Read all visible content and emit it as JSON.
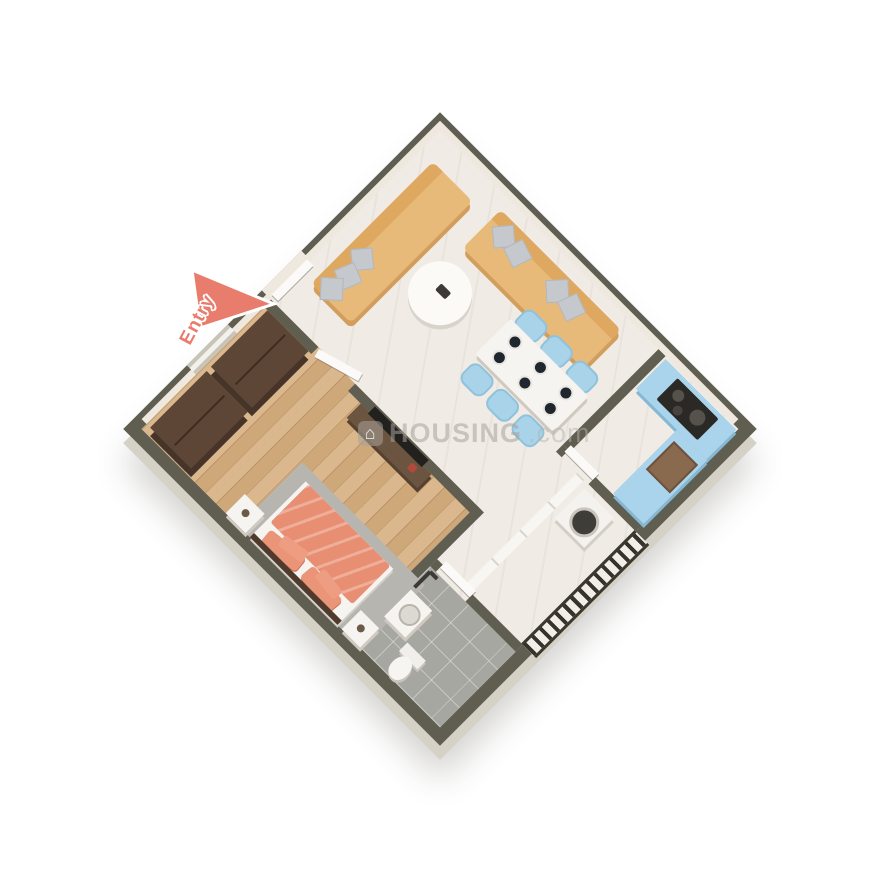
{
  "scene": {
    "type": "3d-isometric-floor-plan-render",
    "background_color": "#ffffff",
    "orientation": "square plan rotated 45deg, viewed from above"
  },
  "labels": {
    "entry": "Entry"
  },
  "watermark": {
    "brand": "HOUSING",
    "suffix": ".com",
    "logo_glyph": "⌂"
  },
  "palette": {
    "wall_top": "#5f5e50",
    "wall_exterior": "#d6d1c7",
    "wall_interior": "#efe8df",
    "marble_floor": "#f0ebe4",
    "wood_floor": "#d5b184",
    "tile_floor": "#a7a7a1",
    "sofa": "#e8ba79",
    "pillow_gray": "#c5c9cd",
    "chair_blue": "#a9d3e9",
    "kitchen_cabinet_blue": "#aad4ec",
    "cooktop": "#2b2926",
    "sink_brown": "#8a6a4f",
    "bed_coral": "#e88f73",
    "wardrobe_brown": "#5d4636",
    "rug_gray": "#b7b5b0",
    "entry_arrow": "#e87d6d",
    "railing_dark": "#35332c"
  },
  "rooms": [
    {
      "name": "living-room",
      "floor": "white-marble",
      "furniture": [
        "three-seat-sofa-left",
        "three-seat-sofa-right",
        "gray-throw-pillows",
        "round-coffee-table"
      ]
    },
    {
      "name": "dining-area",
      "floor": "white-marble",
      "furniture": [
        "marble-dining-table",
        "six-blue-tub-chairs",
        "six-place-settings"
      ]
    },
    {
      "name": "kitchen",
      "floor": "white-marble",
      "furniture": [
        "blue-cooktop-counter",
        "gas-hob",
        "blue-sink-counter",
        "brown-sink-basin"
      ]
    },
    {
      "name": "bedroom",
      "floor": "wood-plank",
      "furniture": [
        "wardrobe-1",
        "wardrobe-2",
        "double-bed-coral",
        "gray-rug",
        "nightstand-left",
        "nightstand-right",
        "tv-console",
        "wall-tv",
        "window"
      ]
    },
    {
      "name": "bathroom",
      "floor": "gray-tile",
      "furniture": [
        "washbasin",
        "toilet",
        "shower-fixture"
      ]
    },
    {
      "name": "balcony",
      "floor": "white-marble",
      "furniture": [
        "washing-machine",
        "railing"
      ]
    },
    {
      "name": "entry-foyer",
      "floor": "white-marble",
      "furniture": [
        "entry-door",
        "bedroom-door",
        "kitchen-door",
        "bathroom-door",
        "balcony-sliding-door"
      ]
    }
  ]
}
